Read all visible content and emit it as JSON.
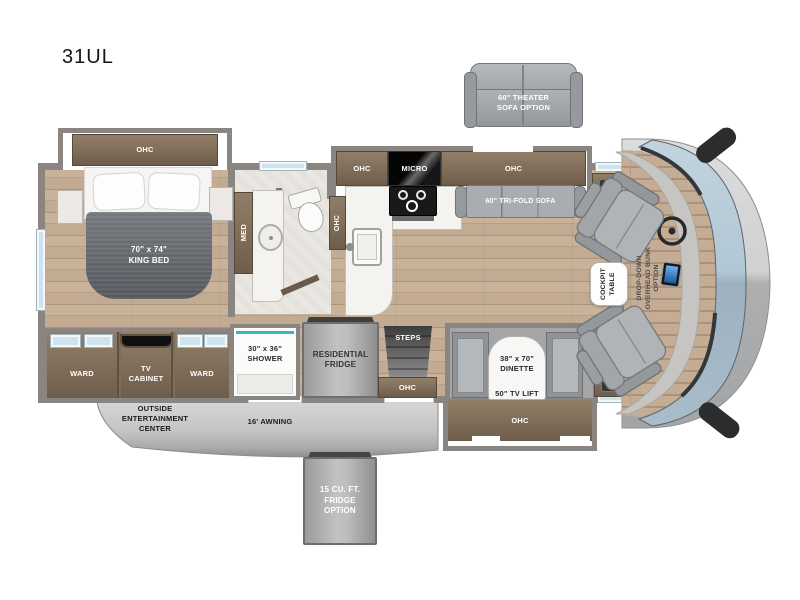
{
  "title": "31UL",
  "colors": {
    "cabinet_wood": "#83705b",
    "wall_gray": "#8a8580",
    "floor_wood": "#c9b29a",
    "window_glass": "#cde3ee",
    "windshield_top": "#bccfdb",
    "windshield_bottom": "#9db1c1",
    "sofa_gray": "#a9adb1",
    "bed_blanket": "#62666b",
    "awning_gray": "#c6c6c6"
  },
  "options": {
    "theater_sofa": "60\" THEATER\nSOFA OPTION",
    "fridge_option": "15 CU. FT.\nFRIDGE\nOPTION",
    "overhead_bunk": "DROP-DOWN\nOVERHEAD BUNK\nOPTION"
  },
  "bedroom": {
    "ohc": "OHC",
    "bed": "70\" x 74\"\nKING BED",
    "med": "MED",
    "ward_left": "WARD",
    "tv_cabinet": "TV\nCABINET",
    "ward_right": "WARD"
  },
  "bath": {
    "ohc": "OHC",
    "shower": "30\" x 36\"\nSHOWER"
  },
  "kitchen": {
    "ohc_left": "OHC",
    "micro": "MICRO",
    "ohc_right": "OHC",
    "residential_fridge": "RESIDENTIAL\nFRIDGE"
  },
  "living": {
    "trifold_sofa": "60\" TRI-FOLD SOFA",
    "dinette": "38\" x 70\"\nDINETTE",
    "tv_lift": "50\" TV LIFT",
    "dinette_ohc": "OHC"
  },
  "entry": {
    "steps": "STEPS",
    "ohc": "OHC"
  },
  "cockpit": {
    "table": "COCKPIT\nTABLE"
  },
  "exterior": {
    "outside_entertainment": "OUTSIDE\nENTERTAINMENT\nCENTER",
    "awning": "16' AWNING"
  }
}
